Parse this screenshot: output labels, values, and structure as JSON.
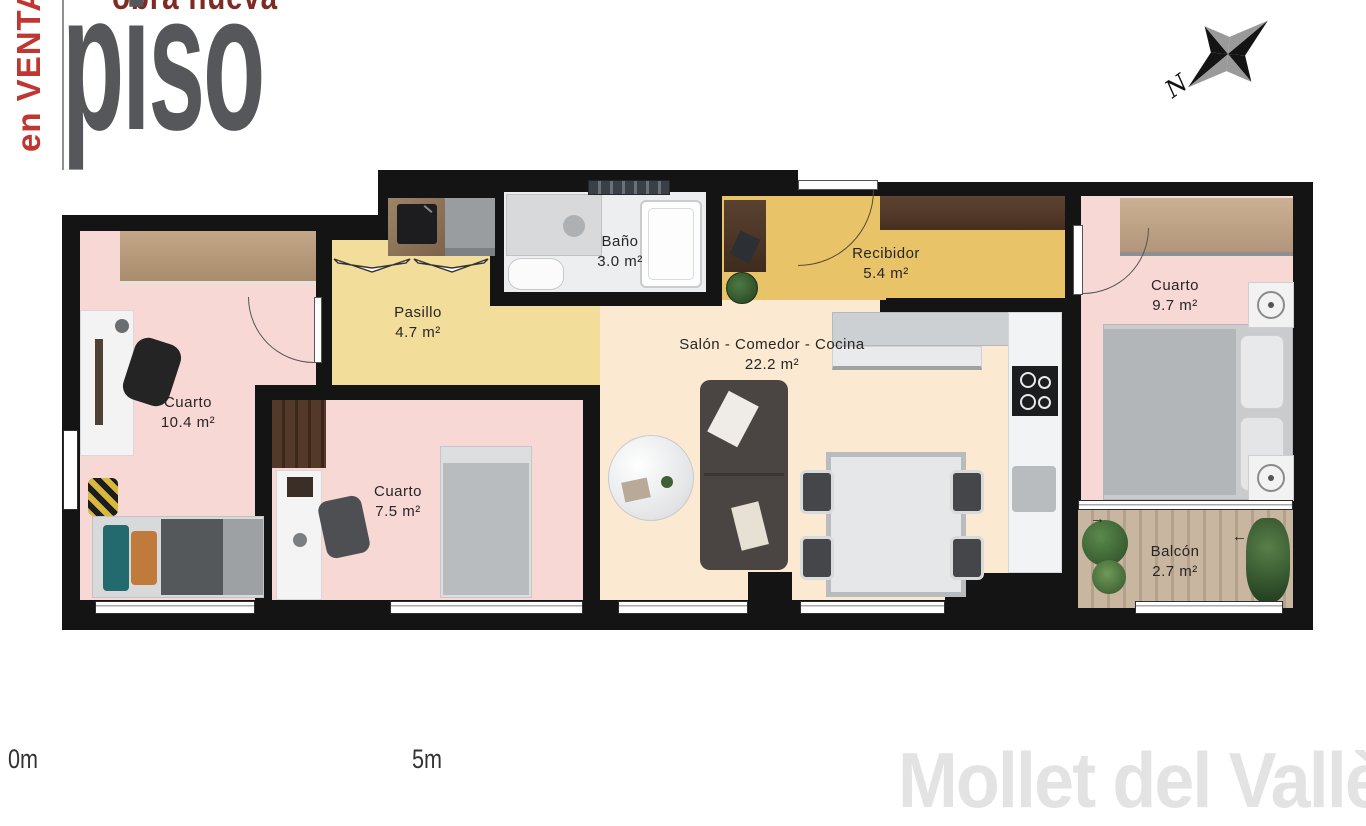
{
  "logo": {
    "obra": "obra nueva",
    "piso": "piso",
    "venta": "en VENTA"
  },
  "compass": {
    "north": "N"
  },
  "rooms": {
    "bano": {
      "name": "Baño",
      "area": "3.0 m²"
    },
    "recibidor": {
      "name": "Recibidor",
      "area": "5.4 m²"
    },
    "cuarto_right": {
      "name": "Cuarto",
      "area": "9.7 m²"
    },
    "pasillo": {
      "name": "Pasillo",
      "area": "4.7 m²"
    },
    "cuarto_left": {
      "name": "Cuarto",
      "area": "10.4 m²"
    },
    "salon": {
      "name": "Salón - Comedor - Cocina",
      "area": "22.2 m²"
    },
    "cuarto_mid": {
      "name": "Cuarto",
      "area": "7.5 m²"
    },
    "balcon": {
      "name": "Balcón",
      "area": "2.7 m²"
    }
  },
  "scale": {
    "start": "0m",
    "end": "5m"
  },
  "watermark": "Mollet del Vallès",
  "colors": {
    "wall": "#141414",
    "room_pink": "#f8d8d5",
    "pasillo_yellow": "#f3dd9a",
    "recibidor_yellow": "#e9c368",
    "salon_peach": "#fbe9d2",
    "bath_floor": "#eceef0",
    "wood_light": "#c2a584",
    "wood_dark": "#50382a",
    "balcony_wood": "#c4b19c",
    "plant": "#41663c",
    "logo_grey": "#56575b",
    "logo_red": "#bf3730",
    "obra_red": "#7c2b25",
    "watermark": "#e3e3e3"
  }
}
